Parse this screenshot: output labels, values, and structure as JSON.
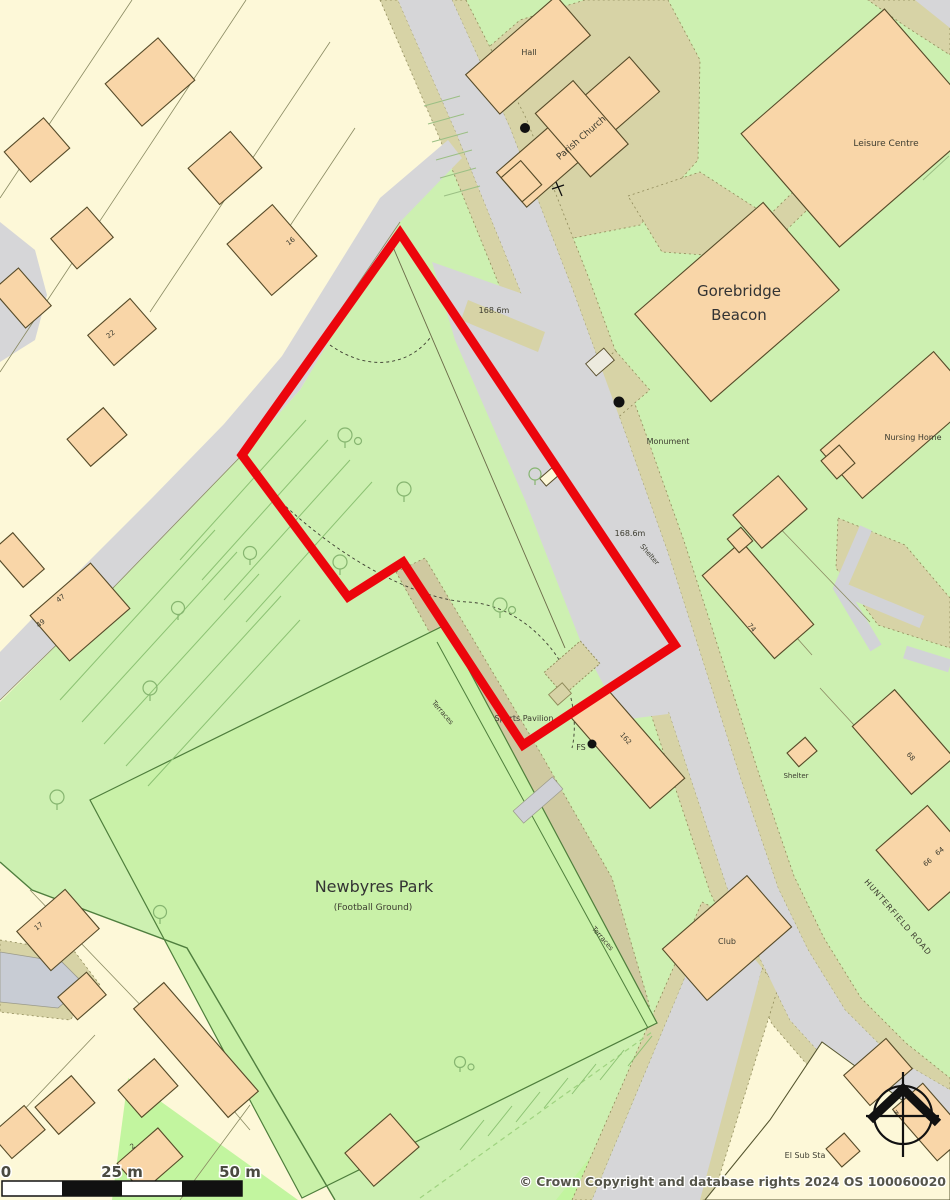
{
  "map": {
    "type": "ordnance-survey-site-plan",
    "location": "Newbyres Park / Hunterfield Road, Gorebridge"
  },
  "labels": {
    "hall": "Hall",
    "parish_church": "Parish Church",
    "leisure_centre": "Leisure Centre",
    "gorebridge_line1": "Gorebridge",
    "gorebridge_line2": "Beacon",
    "spot_height_north": "168.6m",
    "spot_height_south": "168.6m",
    "monument": "Monument",
    "nursing_home": "Nursing Home",
    "shelter_road": "Shelter",
    "shelter_east": "Shelter",
    "sports_pavilion": "Sports Pavilion",
    "fs": "FS",
    "terraces_upper": "Terraces",
    "terraces_lower": "Terraces",
    "newbyres_park": "Newbyres Park",
    "football_ground": "(Football Ground)",
    "club": "Club",
    "hunterfield_road": "HUNTERFIELD ROAD",
    "el_sub_sta": "El Sub Sta",
    "north_n": "N",
    "house_numbers": {
      "n16": "16",
      "n22": "22",
      "n47": "47",
      "n49": "49",
      "n74": "74",
      "n68": "68",
      "n64": "64",
      "n66": "66",
      "n17": "17",
      "n2": "2",
      "n162": "162"
    }
  },
  "scale_bar": {
    "label_zero": "0",
    "label_mid": "25 m",
    "label_end": "50 m"
  },
  "attribution": "© Crown Copyright and database rights 2024 OS 100060020",
  "site_boundary": {
    "color": "#ec050c",
    "points": "400,233 675,645 523,745 403,562 348,597 242,455"
  },
  "colors": {
    "residential_cream": "#fdf8d8",
    "park_green": "#cdf0b1",
    "bright_green": "#c2f59f",
    "pitch_green": "#c9f1a8",
    "road_grey": "#d6d6d8",
    "verge_khaki": "#d7d3a6",
    "building_fill": "#f9d6a8",
    "building_outline": "#554a28"
  }
}
